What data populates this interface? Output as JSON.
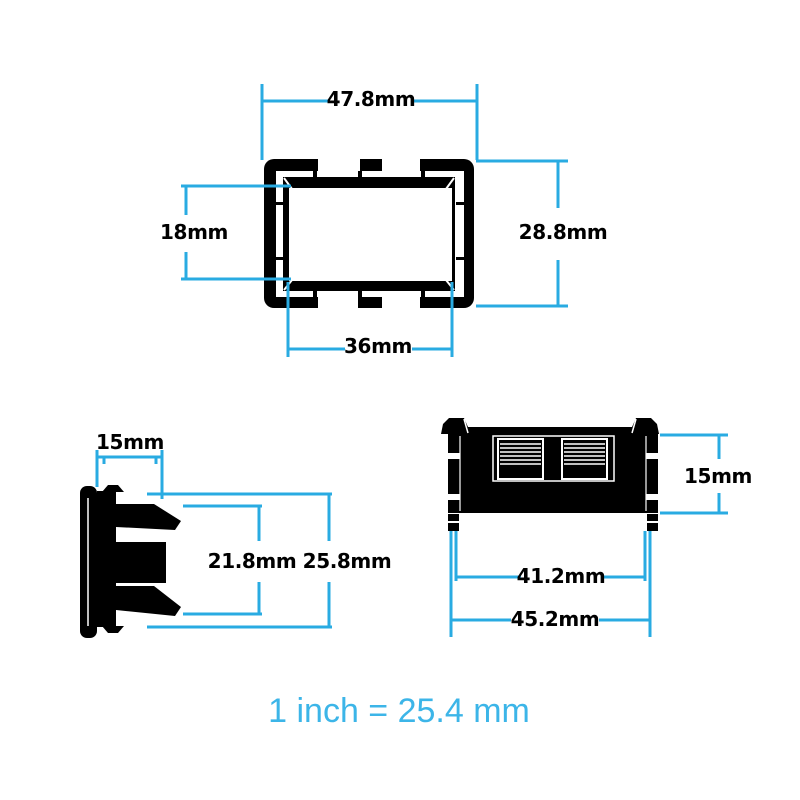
{
  "diagram": {
    "note": "1 inch = 25.4 mm",
    "colors": {
      "dimension_line": "#29ABE2",
      "label_text": "#000000",
      "drawing_fill": "#000000",
      "note_text": "#3CB5E8",
      "background": "#FFFFFF"
    },
    "views": {
      "front": {
        "name": "Front bezel view",
        "dimensions": {
          "outer_width": "47.8mm",
          "outer_height": "28.8mm",
          "opening_height": "18mm",
          "opening_width": "36mm"
        }
      },
      "side": {
        "name": "Side profile view with snap clips",
        "dimensions": {
          "bezel_depth": "15mm",
          "clip_span": "21.8mm",
          "overall_height": "25.8mm"
        }
      },
      "rear": {
        "name": "Rear body view with terminal blocks",
        "dimensions": {
          "body_depth": "15mm",
          "inner_width": "41.2mm",
          "outer_width": "45.2mm"
        }
      }
    }
  }
}
